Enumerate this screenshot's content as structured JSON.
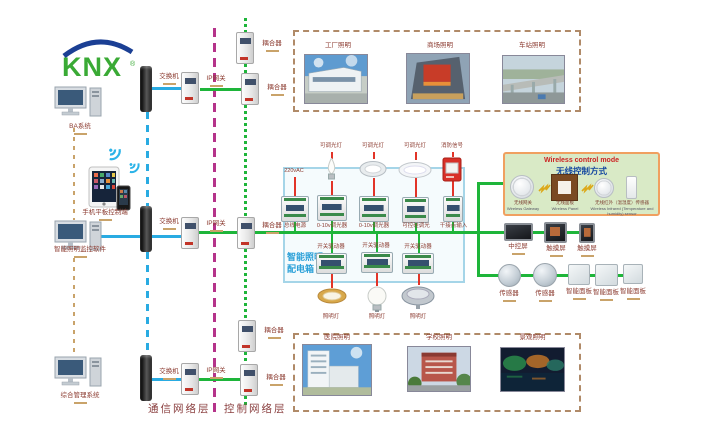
{
  "logo": {
    "brand": "KNX",
    "reg": "®"
  },
  "left_column": {
    "ba_system": "BA系统",
    "mobile_terminal": "手机平板控制端",
    "lighting_monitor": "智能照明监控软件",
    "management_system": "综合管理系统"
  },
  "network": {
    "switch": "交换机",
    "ip_gateway": "IP网关",
    "coupler": "耦合器",
    "comm_layer": "通信网络层",
    "ctrl_layer": "控制网络层"
  },
  "top_applications": [
    "工厂照明",
    "商场照明",
    "车站照明"
  ],
  "bottom_applications": [
    "医院照明",
    "学校照明",
    "景观照明"
  ],
  "distribution_box": {
    "title_line1": "智能照明",
    "title_line2": "配电箱",
    "input_power": "220vAC",
    "input_dimmable": "可调光灯",
    "input_fire": "消防信号",
    "modules_row1": [
      "总线电源",
      "0-10v调光器",
      "0-10v调光器",
      "可控硅调光",
      "干接点输入"
    ],
    "actuator": "开关驱动器",
    "lamp": "照明灯"
  },
  "wireless_box": {
    "title_en": "Wireless control mode",
    "title_zh": "无线控制方式",
    "gateway_zh": "无线网关",
    "gateway_en": "Wireless Gateway",
    "panel_zh": "无线面板",
    "panel_en": "Wireless Panel",
    "sensor_zh": "无线红外（温湿度）传感器",
    "sensor_en": "Wireless Infrared (Temperature and humidity) sensor"
  },
  "control_devices": {
    "central_screen": "中控屏",
    "touch_screen": "触摸屏",
    "sensor": "传感器",
    "smart_panel": "智能面板"
  },
  "colors": {
    "comm_blue": "#29abe2",
    "knx_green": "#1eb53a",
    "mains_red": "#e23428",
    "layer_divider_magenta": "#b5338a",
    "backbone_tan": "#c9a36a"
  }
}
